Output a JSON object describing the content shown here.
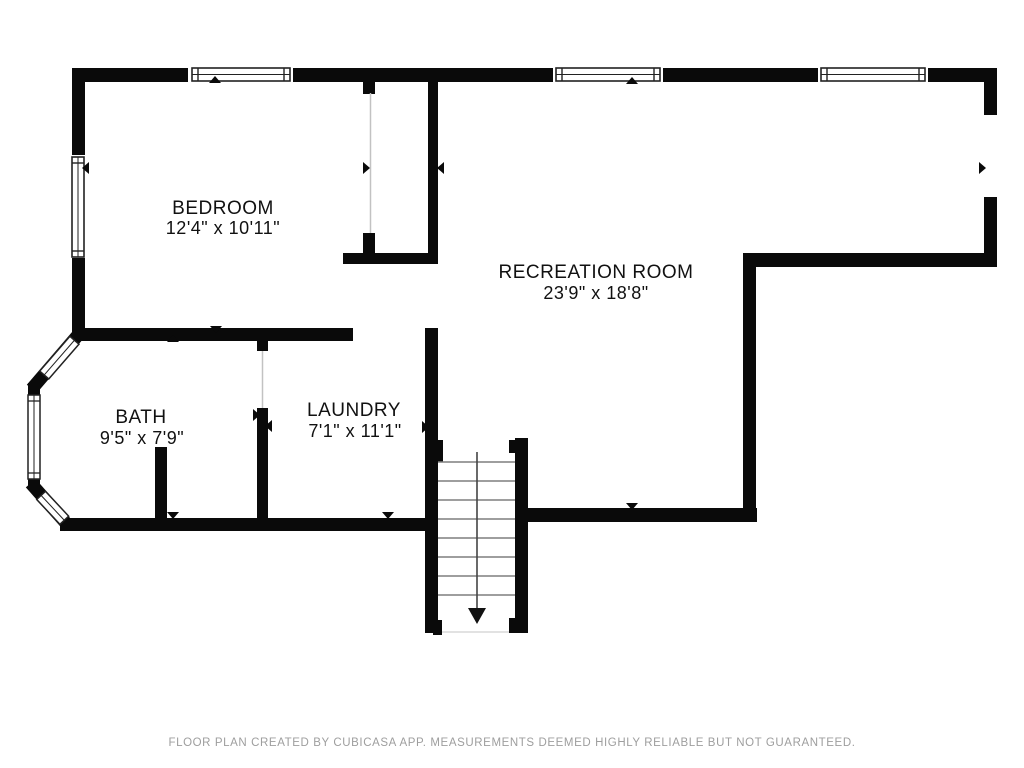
{
  "page": {
    "background": "#ffffff"
  },
  "floor_plan": {
    "rooms": [
      {
        "name": "BEDROOM",
        "dimensions": "12'4\" x 10'11\""
      },
      {
        "name": "RECREATION ROOM",
        "dimensions": "23'9\" x 18'8\""
      },
      {
        "name": "BATH",
        "dimensions": "9'5\" x 7'9\""
      },
      {
        "name": "LAUNDRY",
        "dimensions": "7'1\" x 11'1\""
      }
    ],
    "stairs": {
      "icon": "down-arrow"
    },
    "colors": {
      "walls": "#0a0a0a",
      "opening_lines": "#c2c2c2",
      "stair_treads": "#7f7f7f",
      "window_frame": "#222222",
      "footer_text": "#9e9e9e"
    }
  },
  "footer": {
    "disclaimer": "FLOOR PLAN CREATED BY CUBICASA APP. MEASUREMENTS DEEMED HIGHLY RELIABLE BUT NOT GUARANTEED."
  }
}
